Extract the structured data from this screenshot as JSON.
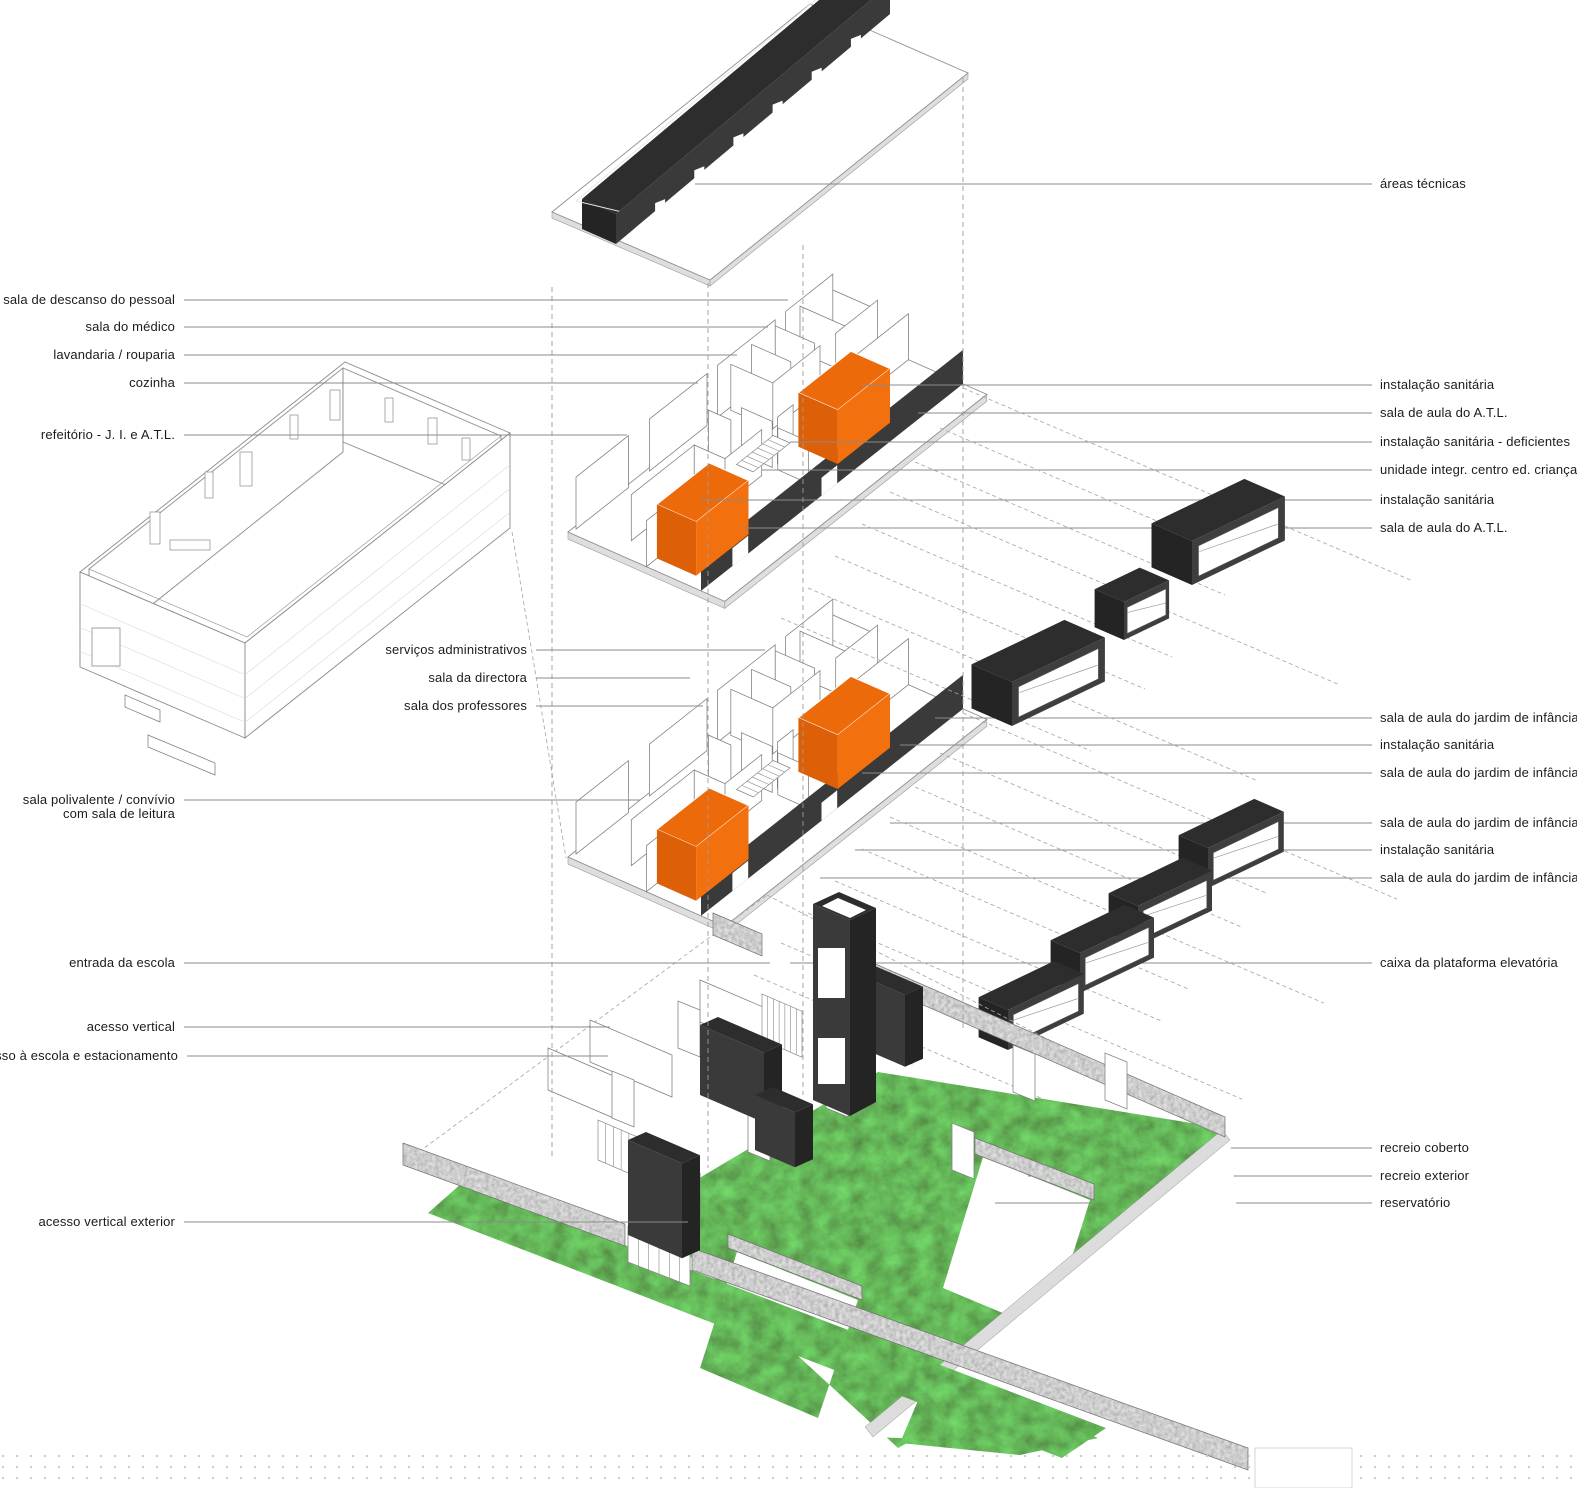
{
  "colors": {
    "accent_orange": "#F2700E",
    "accent_orange_dark": "#DD5F07",
    "accent_orange_top": "#ED6A0B",
    "volume_dark": "#3A3A3A",
    "grass_green": "#4F7F3B",
    "stone_grey": "#AFAFAF",
    "plate_edge": "#DEDEDE",
    "line_grey": "#8B8B8B",
    "background": "#FFFFFF"
  },
  "legend": {
    "left": [
      {
        "label": "sala de descanso do pessoal",
        "y": 300,
        "text_x": 175,
        "end_x": 788
      },
      {
        "label": "sala do médico",
        "y": 327,
        "text_x": 175,
        "end_x": 768
      },
      {
        "label": "lavandaria / rouparia",
        "y": 355,
        "text_x": 175,
        "end_x": 737
      },
      {
        "label": "cozinha",
        "y": 383,
        "text_x": 175,
        "end_x": 698
      },
      {
        "label": "refeitório - J. I. e A.T.L.",
        "y": 435,
        "text_x": 175,
        "end_x": 627
      },
      {
        "label": "serviços administrativos",
        "y": 650,
        "text_x": 527,
        "end_x": 765
      },
      {
        "label": "sala da directora",
        "y": 678,
        "text_x": 527,
        "end_x": 690
      },
      {
        "label": "sala dos professores",
        "y": 706,
        "text_x": 527,
        "end_x": 703
      },
      {
        "label": "sala polivalente /  convívio",
        "label2": "com sala de leitura",
        "y": 800,
        "text_x": 175,
        "end_x": 640
      },
      {
        "label": "entrada da escola",
        "y": 963,
        "text_x": 175,
        "end_x": 770
      },
      {
        "label": "acesso vertical",
        "y": 1027,
        "text_x": 175,
        "end_x": 610
      },
      {
        "label": "de acesso à escola e estacionamento",
        "y": 1056,
        "text_x": 178,
        "end_x": 608
      },
      {
        "label": "acesso vertical exterior",
        "y": 1222,
        "text_x": 175,
        "end_x": 688
      }
    ],
    "right": [
      {
        "label": "áreas técnicas",
        "y": 184,
        "start_x": 695
      },
      {
        "label": "instalação sanitária",
        "y": 385,
        "start_x": 862
      },
      {
        "label": "sala de aula do A.T.L.",
        "y": 413,
        "start_x": 918
      },
      {
        "label": "instalação sanitária - deficientes",
        "y": 442,
        "start_x": 790
      },
      {
        "label": "unidade integr. centro ed. crianças deficie",
        "y": 470,
        "start_x": 762
      },
      {
        "label": "instalação sanitária",
        "y": 500,
        "start_x": 700
      },
      {
        "label": "sala de aula do A.T.L.",
        "y": 528,
        "start_x": 742
      },
      {
        "label": "sala de aula do jardim de infância",
        "y": 718,
        "start_x": 935
      },
      {
        "label": "instalação sanitária",
        "y": 745,
        "start_x": 900
      },
      {
        "label": "sala de aula do jardim de infância",
        "y": 773,
        "start_x": 862
      },
      {
        "label": "sala de aula do jardim de infância",
        "y": 823,
        "start_x": 890
      },
      {
        "label": "instalação sanitária",
        "y": 850,
        "start_x": 855
      },
      {
        "label": "sala de aula do jardim de infância",
        "y": 878,
        "start_x": 820
      },
      {
        "label": "caixa da plataforma elevatória",
        "y": 963,
        "start_x": 790
      },
      {
        "label": "recreio coberto",
        "y": 1148,
        "start_x": 880
      },
      {
        "label": "recreio exterior",
        "y": 1176,
        "start_x": 1028
      },
      {
        "label": "reservatório",
        "y": 1203,
        "start_x": 995
      }
    ]
  }
}
